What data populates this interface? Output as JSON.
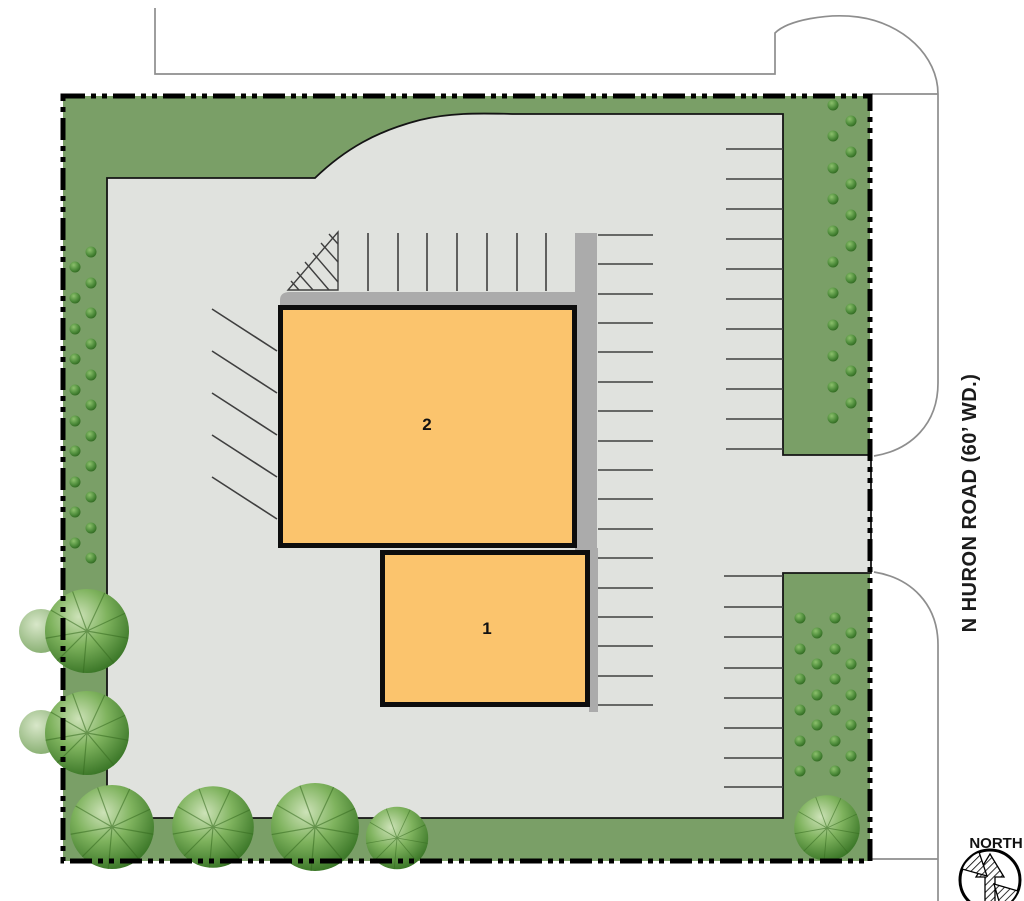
{
  "plan": {
    "road_label": "N HURON ROAD (60’ WD.)",
    "north_label": "NORTH",
    "buildings": [
      {
        "label": "1"
      },
      {
        "label": "2"
      }
    ],
    "colors": {
      "landscape_green": "#7A9F67",
      "pavement_gray": "#E0E2DE",
      "sidewalk_gray": "#ABABAB",
      "building_orange": "#FBC46D",
      "boundary_black": "#000000",
      "curb_line_gray": "#8E8E8E",
      "shrub_green": "#4E8C3B",
      "tree_green": "#2F6C1E"
    }
  }
}
